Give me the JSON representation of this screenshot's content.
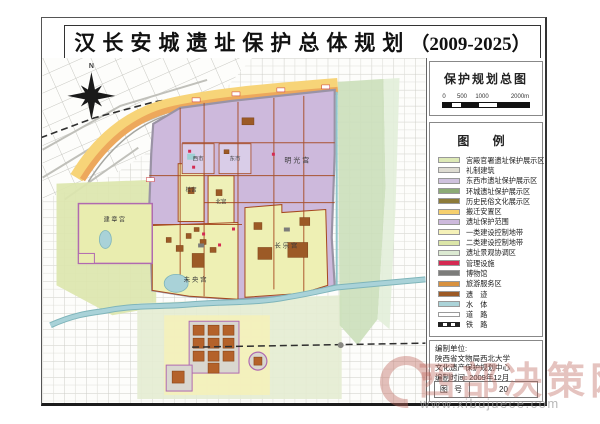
{
  "title": {
    "cn": "汉长安城遗址保护总体规划",
    "years": "（2009-2025）"
  },
  "panel": {
    "map_title": "保护规划总图",
    "scale": {
      "labels": [
        "0",
        "500",
        "1000",
        "2000m"
      ]
    },
    "legend_title": "图 例",
    "legend_items": [
      {
        "label": "宫殿官署遗址保护展示区",
        "swatch": "fill",
        "color": "#dde9b6"
      },
      {
        "label": "礼制建筑",
        "swatch": "fill",
        "color": "#dedcd2"
      },
      {
        "label": "东西市遗址保护展示区",
        "swatch": "fill",
        "color": "#cfc2de"
      },
      {
        "label": "环城遗址保护展示区",
        "swatch": "fill",
        "color": "#8cab76"
      },
      {
        "label": "历史民俗文化展示区",
        "swatch": "fill",
        "color": "#8d7b39"
      },
      {
        "label": "搬迁安置区",
        "swatch": "fill",
        "color": "#f6d06e"
      },
      {
        "label": "遗址保护范围",
        "swatch": "fill",
        "color": "#cdb9dc"
      },
      {
        "label": "一类建设控制地带",
        "swatch": "fill",
        "color": "#f5f1b8"
      },
      {
        "label": "二类建设控制地带",
        "swatch": "fill",
        "color": "#dce6a8"
      },
      {
        "label": "遗址景观协调区",
        "swatch": "fill",
        "color": "#dcead2"
      },
      {
        "label": "管理设施",
        "swatch": "fill",
        "color": "#d42a52"
      },
      {
        "label": "博物馆",
        "swatch": "fill",
        "color": "#7c7c7a"
      },
      {
        "label": "旅游服务区",
        "swatch": "fill",
        "color": "#d8913f"
      },
      {
        "label": "遗　迹",
        "swatch": "fill",
        "color": "#9c5a26"
      },
      {
        "label": "水　体",
        "swatch": "fill",
        "color": "#abd3d8"
      },
      {
        "label": "道　路",
        "swatch": "road",
        "color": "#ffffff"
      },
      {
        "label": "铁　路",
        "swatch": "rail",
        "color": "#222222"
      }
    ],
    "credits": {
      "line1": "编制单位:",
      "line2": "陕西省文物局西北大学",
      "line3": "文化遗产保护规划中心",
      "line4": "编制时间: 2009年12月",
      "fig_label": "图 号",
      "fig_value": "20"
    }
  },
  "map": {
    "compass": "N",
    "labels": {
      "jianzhanggong": "建 章 宫",
      "weiyanggong": "未 央 宫",
      "changlegong": "长 乐 宫",
      "beigong": "北宫",
      "guigong": "桂宫",
      "xishi": "西市",
      "dongshi": "东市",
      "mingguanggong": "明 光 宫"
    }
  },
  "watermark": {
    "brand": "西部决策网",
    "url": "www.xibujuece.com"
  }
}
